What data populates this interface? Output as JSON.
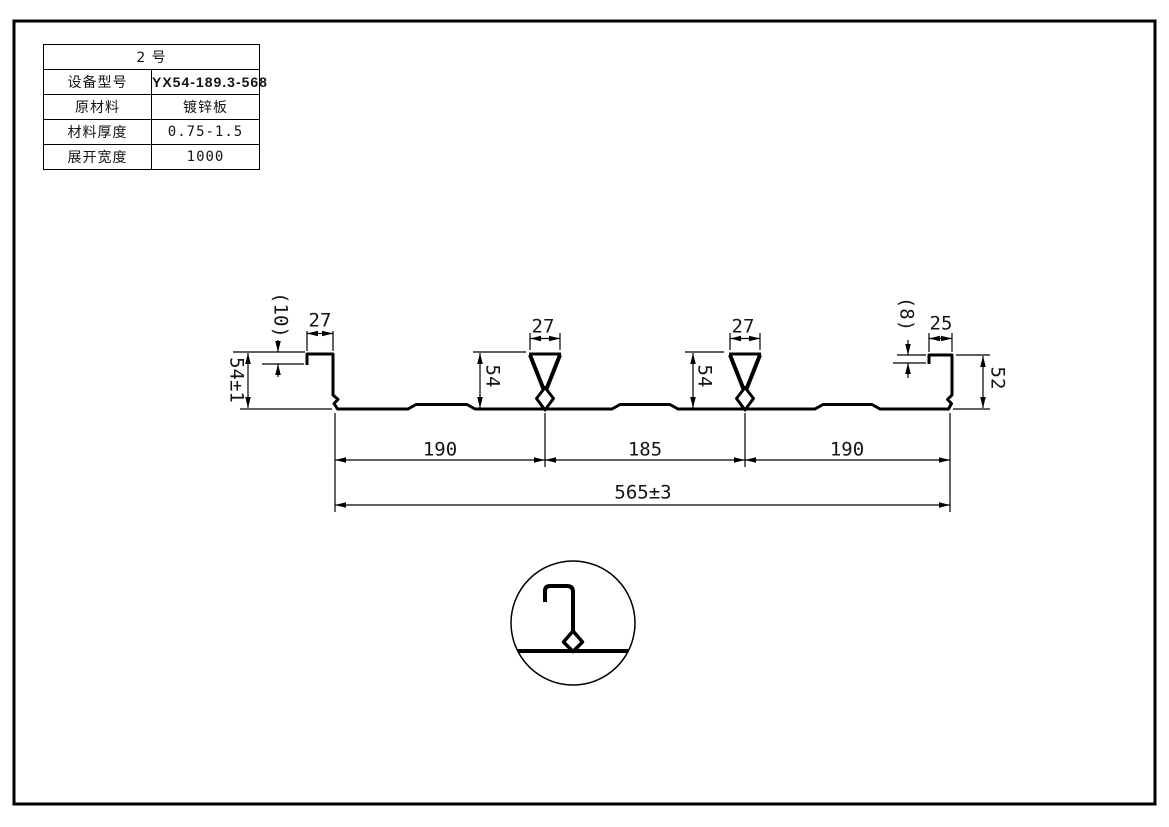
{
  "sheet": {
    "spec_table": {
      "title": "2  号",
      "rows": [
        {
          "label": "设备型号",
          "value": "YX54-189.3-568"
        },
        {
          "label": "原材料",
          "value": "镀锌板"
        },
        {
          "label": "材料厚度",
          "value": "0.75-1.5"
        },
        {
          "label": "展开宽度",
          "value": "1000"
        }
      ]
    },
    "dimensions": {
      "left_lip_height": "(10)",
      "left_flange_width": "27",
      "left_web_height": "54±1",
      "rib1_top_width": "27",
      "rib1_height": "54",
      "rib2_top_width": "27",
      "rib2_height": "54",
      "right_lip_height": "(8)",
      "right_flange_width": "25",
      "right_web_height": "52",
      "pitch_left": "190",
      "pitch_middle": "185",
      "pitch_right": "190",
      "overall_width": "565±3"
    },
    "colors": {
      "line": "#000000",
      "background": "#ffffff"
    }
  }
}
